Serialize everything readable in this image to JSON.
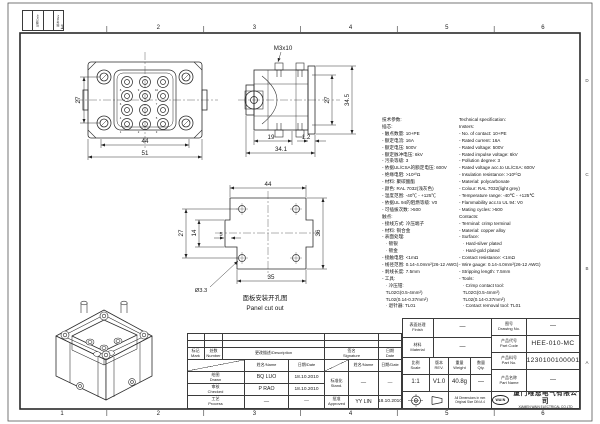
{
  "zones": {
    "top": [
      "1",
      "2",
      "3",
      "4",
      "5",
      "6"
    ],
    "bottom": [
      "1",
      "2",
      "3",
      "4",
      "5",
      "6"
    ],
    "letters": [
      "D",
      "C",
      "B",
      "A"
    ]
  },
  "corner": {
    "col1": "日期/Date",
    "col2": "版本/Rev"
  },
  "views": {
    "front": {
      "dim_pitch_v": "27",
      "dim_inner_w": "44",
      "dim_outer_w": "51",
      "contacts": [
        "1",
        "2",
        "3",
        "4",
        "5",
        "6",
        "7",
        "8",
        "9",
        "10"
      ]
    },
    "side": {
      "thread_label": "M3x10",
      "dim_pitch": "27",
      "dim_height": "34.5",
      "dim_depth": "19",
      "dim_flange": "1.2",
      "dim_total_depth": "34.1"
    },
    "cutout": {
      "dim_w_top": "44",
      "dim_hole_pitch": "27",
      "dim_mid": "14",
      "dim_step": "5",
      "dim_w_bottom": "35",
      "dim_h": "36",
      "hole_dia": "Ø3.3",
      "caption_zh": "面板安装开孔图",
      "caption_en": "Panel cut out"
    }
  },
  "specs": {
    "zh": [
      "技术参数:",
      "插芯:",
      "- 触点数量: 10+PE",
      "- 额定电流: 16A",
      "- 额定电压: 500V",
      "- 额定脉冲电压: 6kV",
      "- 污染等级: 3",
      "- 依据UL/CSA的额定电压: 600V",
      "- 绝缘电阻: >10¹⁰Ω",
      "- 材料: 聚碳酸酯",
      "- 颜色: RAL 7032(浅灰色)",
      "- 温度范围: -40℃ - +125℃",
      "- 依据UL 94的阻燃等级: V0",
      "- 可插拔次数: >500",
      "触点:",
      "- 接线方式: 冷压端子",
      "- 材料: 铜合金",
      "- 表面处理:",
      "   · 镀银",
      "   · 镀金",
      "- 接触电阻: <1mΩ",
      "- 线径范围: 0.14-4.0mm²(26-12 AWG)",
      "- 剥线长度: 7.5mm",
      "- 工具:",
      "   · 冷压钳:",
      "   TL02G(0.5-4mm²)",
      "   TL02(0.14-0.37mm²)",
      "   · 退针器: TL01"
    ],
    "en": [
      "Technical specification:",
      "Insters:",
      "- No. of contact: 10+PE",
      "- Rated current: 16A",
      "- Rated voltage: 500V",
      "- Rated impulse voltage: 6kV",
      "- Pollution degree: 3",
      "- Rated voltage acc.to UL/CSA: 600V",
      "- Insulation resistance: >10¹⁰Ω",
      "- Material: polycarbonate",
      "- Colour: RAL 7032(light grey)",
      "- Temperature range: -40℃ - +125℃",
      "- Flammability acc.to UL 94: V0",
      "- Mating cycles: >500",
      "Contacts:",
      "- Terminal: crimp terminal",
      "- Material: copper alloy",
      "- Surface:",
      "   · Hard-silver plated",
      "   · Hard-gold plated",
      "- Contact resistance: <1mΩ",
      "- Wire gauge: 0.14-4.0mm²(26-12 AWG)",
      "- Stripping length: 7.5mm",
      "- Tools:",
      "   · Crimp contact tool:",
      "   TL02G(0.5-4mm²)",
      "   TL02(0.14-0.37mm²)",
      "   · Contact removal tool: TL01"
    ]
  },
  "tb": {
    "left": {
      "mark": "标记\nMark",
      "number": "处数\nNumber",
      "description": "更改描述/Description",
      "signature": "签名\nSignature",
      "date": "日期\nDate",
      "name_sub": "姓名/Name",
      "date_sub": "日期/Date",
      "drawn": "绘图\nDrawn",
      "drawn_name": "BQ  LUO",
      "drawn_date": "18.10.2010",
      "checked": "审核\nChecked",
      "checked_name": "P  RAO",
      "checked_date": "18.10.2010",
      "process": "工艺\nProcess",
      "process_name": "—",
      "process_date": "—",
      "stand": "标准化\nStand.",
      "stand_name": "—",
      "stand_date": "—",
      "approved": "批准\nApproved",
      "approved_name": "YY  LIN",
      "approved_date": "18.10.2010"
    },
    "right": {
      "finish_label": "表面处理\nFinish",
      "finish_value": "—",
      "material_label": "材料\nMaterial",
      "material_value": "—",
      "scale_label": "比例\nScale",
      "scale_value": "1:1",
      "rev_label": "版本\nREV.",
      "rev_value": "V1.0",
      "weight_label": "重量\nWeight",
      "weight_value": "40.8g",
      "qty_label": "数量\nQty.",
      "qty_value": "—",
      "drawing_no_label": "图号\nDrawing No.",
      "drawing_no_value": "—",
      "part_code_label": "产品代号\nPart Code",
      "part_code_value": "HEE-010-MC",
      "part_no_label": "产品料号\nPart No.",
      "part_no_value": "1230100100001",
      "part_name_label": "产品名称\nPart Name",
      "part_name_value": "—",
      "dims_note": "All Dimensions in mm\nOriginal Size DIN A 4",
      "logo_text": "WAIN",
      "company_zh": "厦门唯恩电气有限公司",
      "company_en": "XIAMEN WAIN ELECTRICAL CO.LTD"
    }
  }
}
